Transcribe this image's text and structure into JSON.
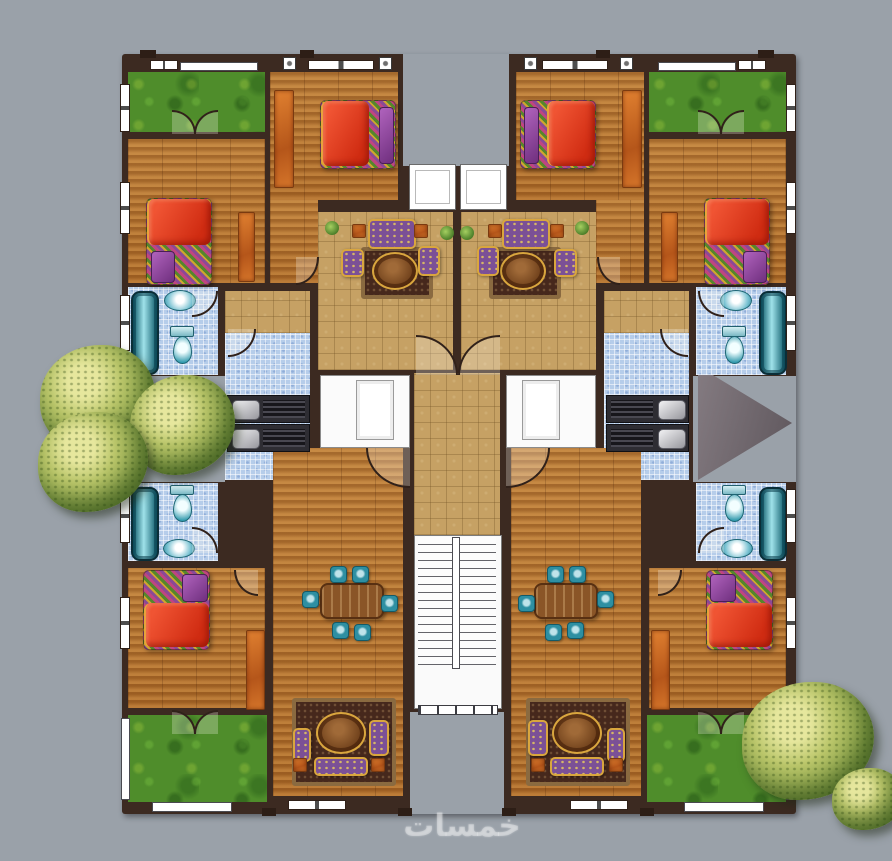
{
  "watermark": {
    "text": "خمسات"
  },
  "palette": {
    "paver_gray": "#9aa1a9",
    "wall_brown": "#3c2a21",
    "wood_floor": "#b06f2e",
    "ceramic_tan": "#c6a164",
    "bath_tile_blue": "#b6cdea",
    "grass_green": "#4f8d2b",
    "blanket_red": "#d02c12",
    "pillow_purple": "#6f2f7e",
    "fixture_teal": "#2e8fa2",
    "wardrobe_orange": "#c96a1f",
    "tree_yellow_green": "#bac66a",
    "stair_white": "#fafafa"
  },
  "plan": {
    "type": "residential apartment floor plan, top view, two mirrored wings",
    "units": [
      {
        "id": "upper-left",
        "rooms": [
          "balcony-garden",
          "bedroom-1",
          "bedroom-2",
          "living-room",
          "entry-hall",
          "bathroom",
          "kitchen"
        ]
      },
      {
        "id": "upper-right",
        "rooms": [
          "balcony-garden",
          "bedroom-1",
          "bedroom-2",
          "living-room",
          "entry-hall",
          "bathroom",
          "kitchen"
        ]
      },
      {
        "id": "lower-left",
        "rooms": [
          "bathroom",
          "bedroom",
          "living-dining-room",
          "garden"
        ]
      },
      {
        "id": "lower-right",
        "rooms": [
          "bathroom",
          "bedroom",
          "living-dining-room",
          "garden"
        ]
      }
    ],
    "core": [
      "entry-recess",
      "twin-entry-doors",
      "corridor",
      "closets",
      "u-shaped-staircase",
      "rear-courtyard"
    ],
    "furniture": {
      "beds": 6,
      "sofa_sets": 4,
      "dining_tables_with_6_chairs": 2,
      "bathtubs": 4,
      "toilets": 4,
      "wash_basins": 4,
      "kitchen_counters_with_sinks": 4,
      "wardrobes_rugs_orange": 6
    },
    "environment": [
      "herringbone-paver-ground",
      "large-tree-left",
      "bush-bottom-right",
      "shadow-triangle-right"
    ]
  }
}
